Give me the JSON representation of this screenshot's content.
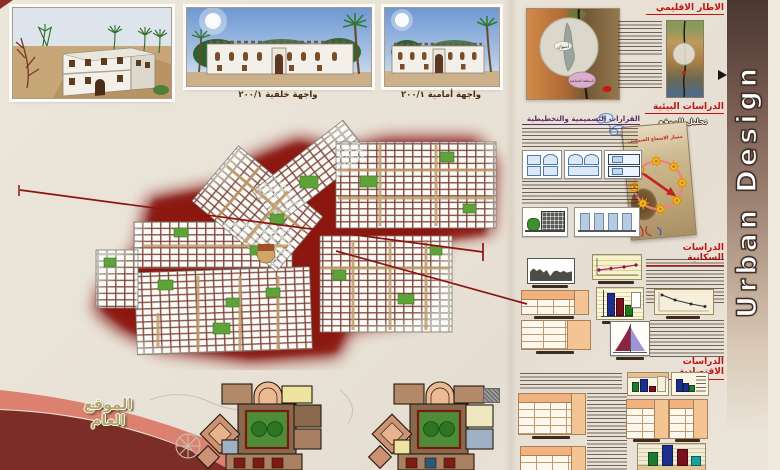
{
  "banner": {
    "title": "Urban Design"
  },
  "renderings": {
    "back_caption": "واجهة خلفية ٢٠٠/١",
    "front_caption": "واجهة أمامية ٢٠٠/١"
  },
  "regional": {
    "title": "الاطار الاقليمي",
    "map_city_label": "أسوان",
    "map_zone_label": "المنطقة الصناعية"
  },
  "environmental": {
    "title": "الدراسات البيئية",
    "site_analysis_label": "تحليل الموقع",
    "decisions_title": "القرارات التصميمية والتخطيطية",
    "sun_path_label": "مسار الاشعاع الشمسي"
  },
  "population": {
    "title": "الدراسات السكانية"
  },
  "economic": {
    "title": "الدراسات الاقتصادية"
  },
  "site_plan": {
    "label": "الموقع العام"
  },
  "colors": {
    "accent_red": "#c41410",
    "plan_glow": "#7a100b",
    "banner_dark": "#4a3631",
    "swoosh_salmon": "#dc8170",
    "swoosh_maroon": "#7c2d27"
  }
}
